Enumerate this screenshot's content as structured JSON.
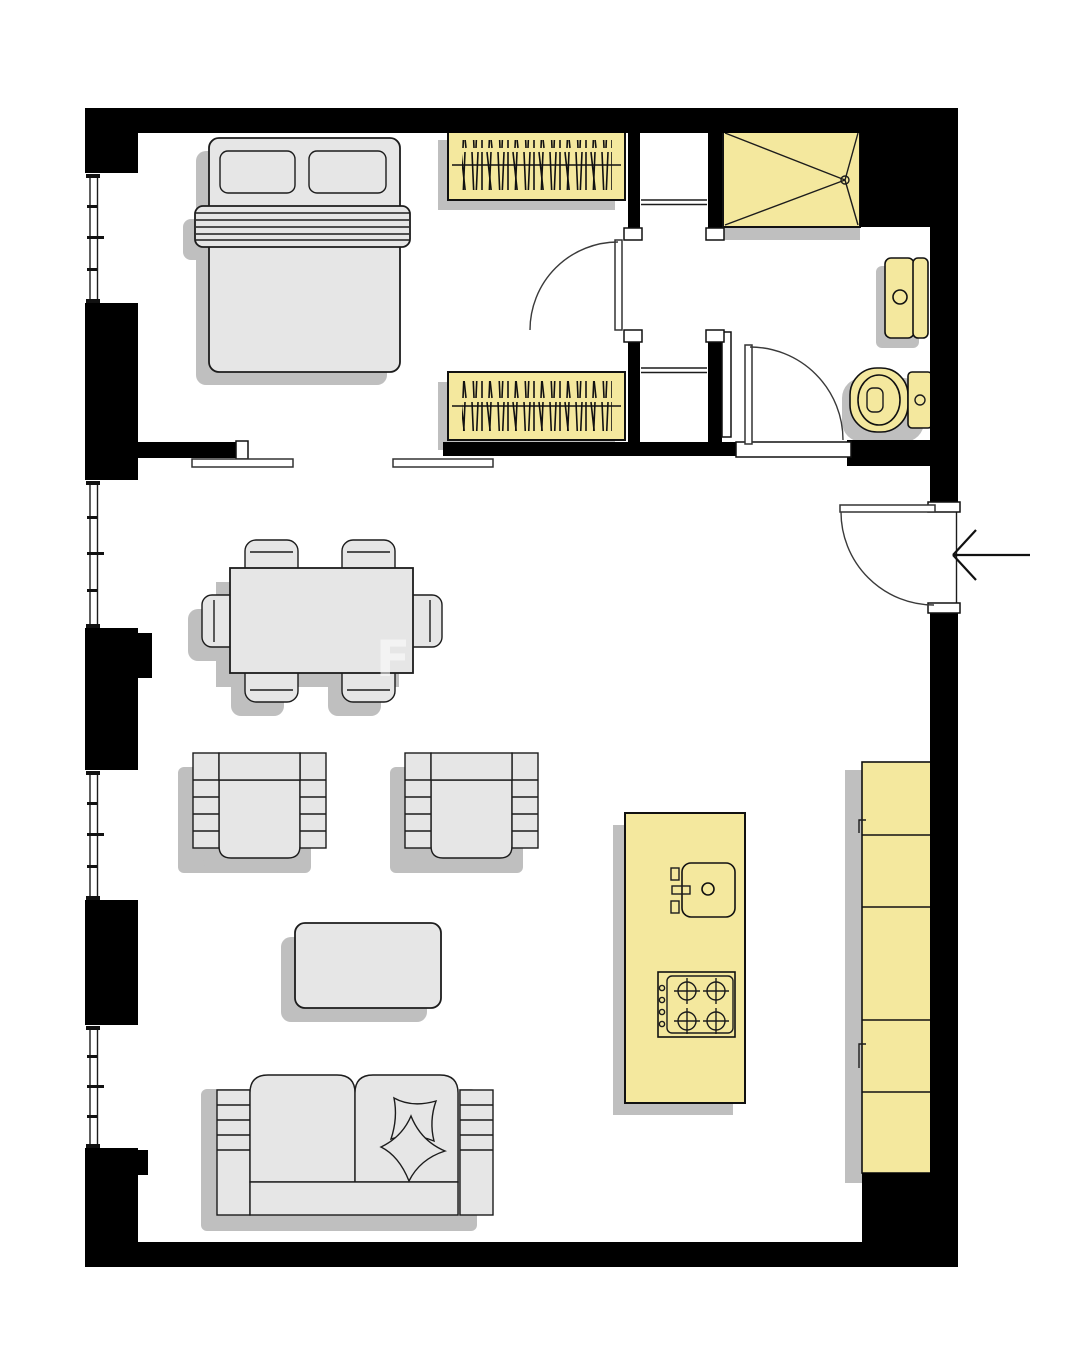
{
  "plan": {
    "type": "apartment-floor-plan",
    "watermark": "F",
    "colors": {
      "wall": "#000000",
      "floor": "#ffffff",
      "fixture_yellow": "#f4e89e",
      "furniture_gray": "#e6e6e6",
      "shadow_gray": "#bfbfbf",
      "outline": "#111111",
      "door_arc": "#3a3a3a"
    },
    "rooms": [
      {
        "name": "bedroom",
        "position": "top-left"
      },
      {
        "name": "hallway-vestibule",
        "position": "top-center"
      },
      {
        "name": "bathroom",
        "position": "top-right"
      },
      {
        "name": "living-room-kitchen",
        "position": "center-bottom"
      },
      {
        "name": "entry",
        "position": "right"
      }
    ],
    "windows": {
      "count": 4,
      "wall": "left"
    },
    "doors": [
      {
        "name": "bedroom-door",
        "swing": "into-bedroom"
      },
      {
        "name": "bathroom-door",
        "swing": "into-bathroom"
      },
      {
        "name": "entrance-door",
        "swing": "inward",
        "marker": "entrance-arrow"
      }
    ],
    "furniture": [
      {
        "name": "double-bed",
        "room": "bedroom",
        "parts": [
          "pillow",
          "pillow",
          "blanket-band"
        ]
      },
      {
        "name": "wardrobe-upper",
        "room": "bedroom",
        "style": "hanging-clothes-hatch"
      },
      {
        "name": "wardrobe-lower",
        "room": "bedroom",
        "style": "hanging-clothes-hatch"
      },
      {
        "name": "dining-table",
        "room": "living-room-kitchen",
        "chairs": 6
      },
      {
        "name": "armchair-left",
        "room": "living-room-kitchen"
      },
      {
        "name": "armchair-right",
        "room": "living-room-kitchen"
      },
      {
        "name": "coffee-table",
        "room": "living-room-kitchen"
      },
      {
        "name": "sofa-two-seat",
        "room": "living-room-kitchen",
        "pillows": 2
      }
    ],
    "fixtures": [
      {
        "name": "shower",
        "room": "bathroom"
      },
      {
        "name": "washbasin",
        "room": "bathroom"
      },
      {
        "name": "toilet",
        "room": "bathroom"
      },
      {
        "name": "kitchen-island",
        "room": "living-room-kitchen",
        "parts": [
          "sink",
          "gas-hob-4-burners"
        ]
      },
      {
        "name": "kitchen-counter-run",
        "room": "living-room-kitchen",
        "units": 5
      }
    ]
  }
}
